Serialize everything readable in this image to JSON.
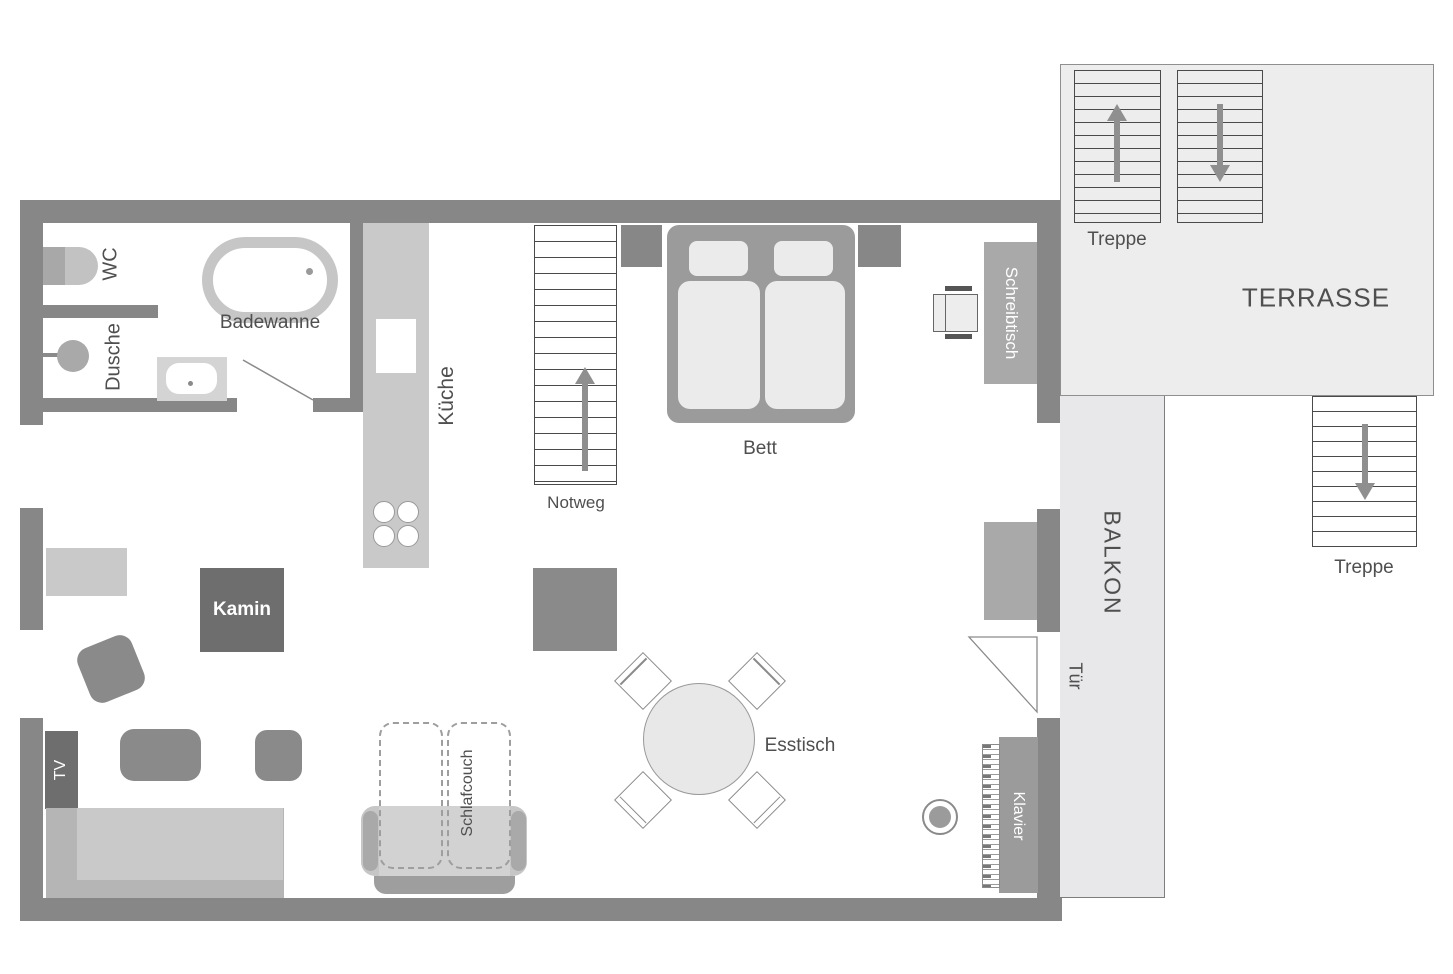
{
  "floorplan": {
    "bathroom": {
      "wc": "WC",
      "dusche": "Dusche",
      "badewanne": "Badewanne"
    },
    "kitchen": {
      "kueche": "Küche"
    },
    "sleeping": {
      "bett": "Bett",
      "notweg": "Notweg",
      "schreibtisch": "Schreibtisch"
    },
    "living": {
      "kamin": "Kamin",
      "tv": "TV",
      "schlafcouch": "Schlafcouch",
      "esstisch": "Esstisch",
      "klavier": "Klavier"
    },
    "outdoor": {
      "terrasse": "TERRASSE",
      "balkon": "BALKON",
      "tuer": "Tür",
      "treppe_terrasse": "Treppe",
      "treppe_aussen": "Treppe"
    },
    "colors": {
      "wall": "#878787",
      "furniture_dark": "#6e6e6e",
      "furniture_mid": "#9b9b9b",
      "furniture_light": "#c9c9c9",
      "outdoor_fill": "#ededee",
      "text": "#4f4f4f",
      "arrow": "#8f8f8f"
    }
  }
}
